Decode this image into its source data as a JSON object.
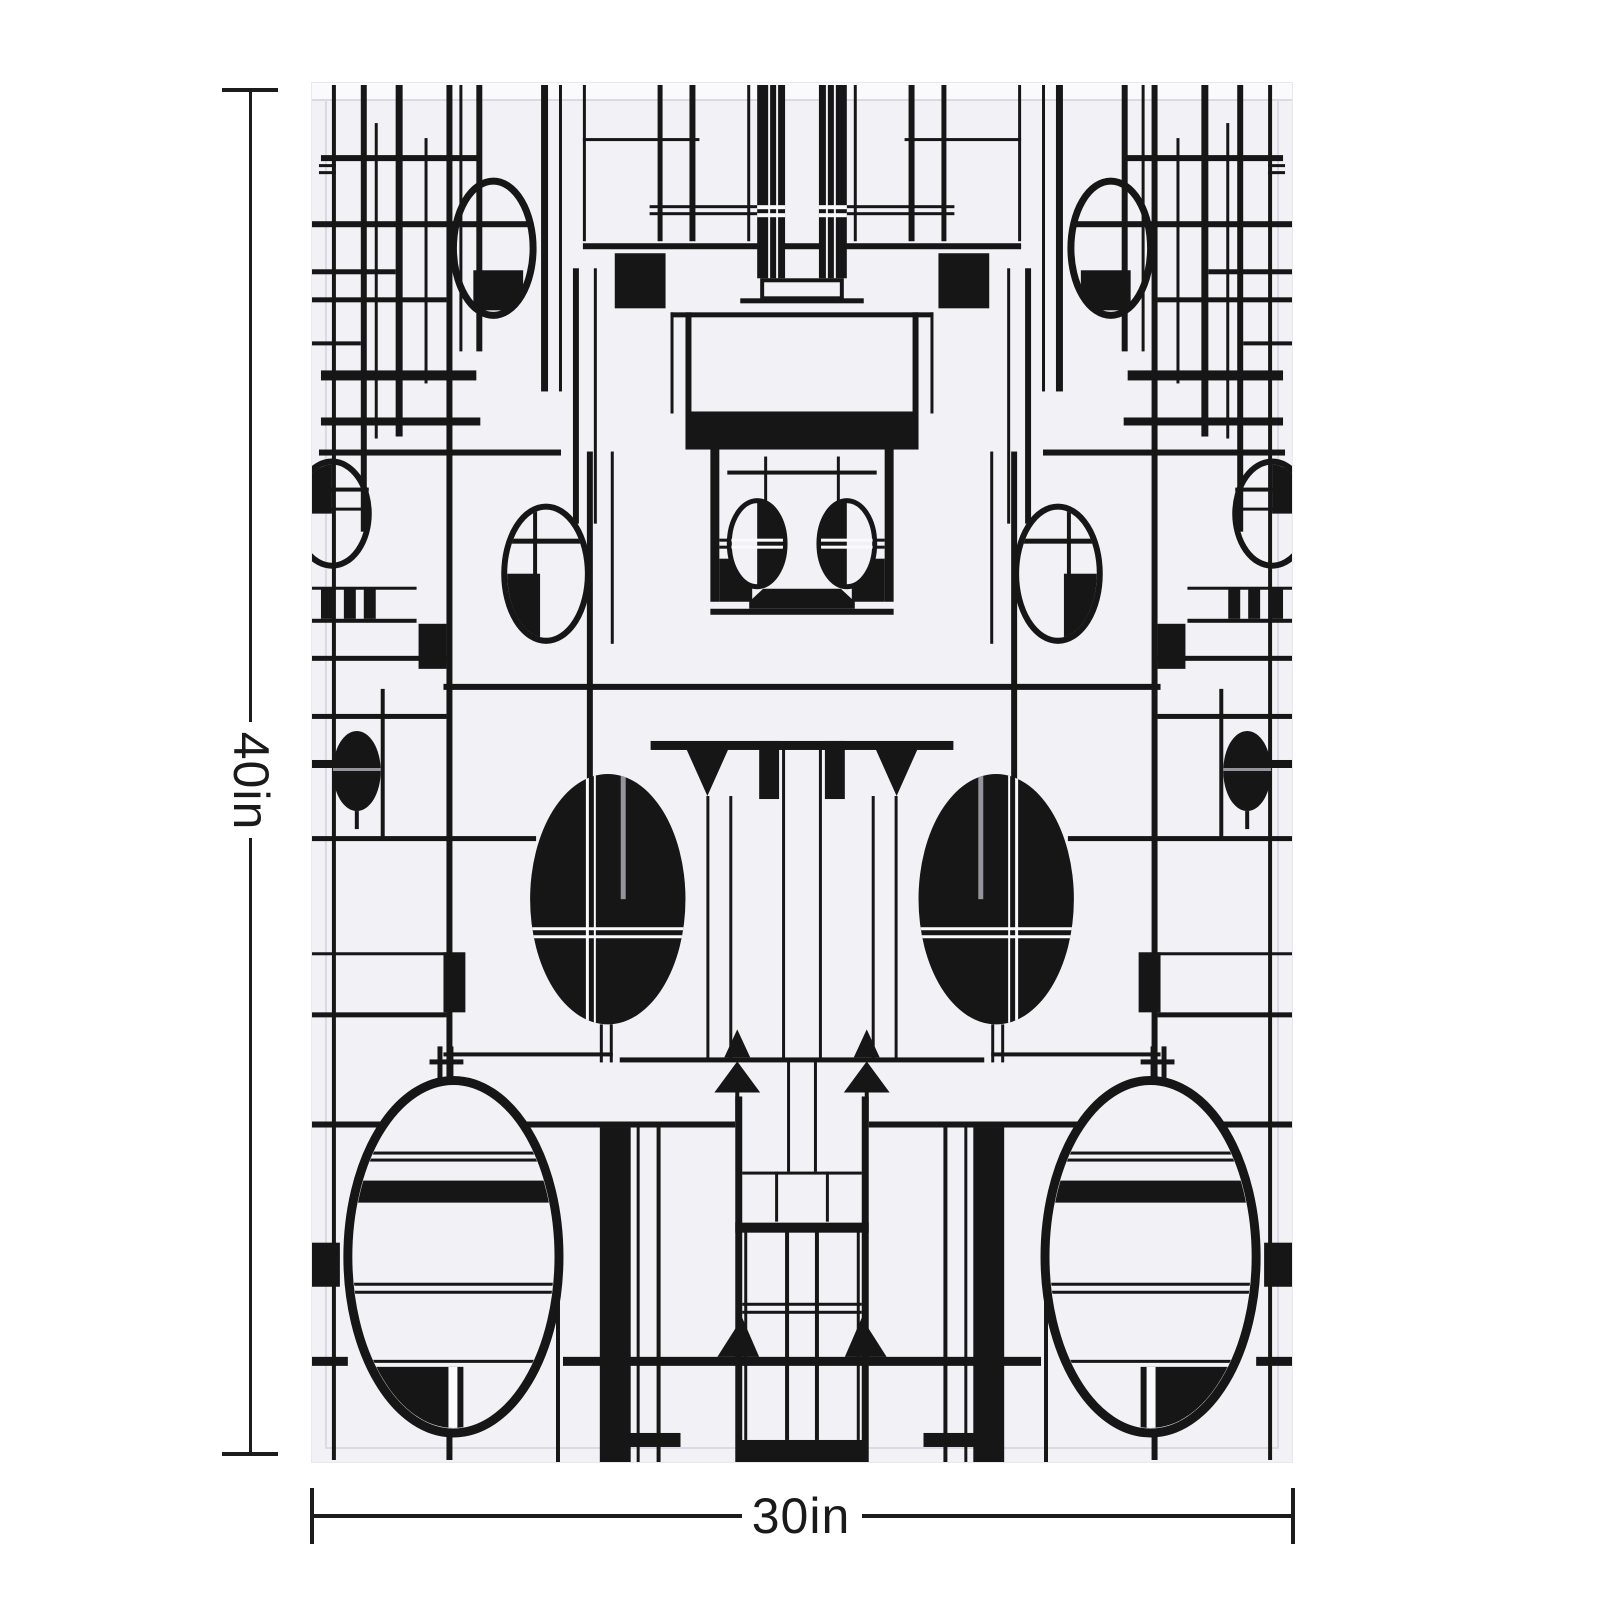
{
  "image_type": "product size mockup",
  "artwork": {
    "title": "black-white-geometric-abstract-pattern",
    "style": "Mondrian and Art-Deco inspired mirror-symmetric composition of black grid lines, rectangles, triangles and ellipses on a pale panel",
    "colors": {
      "ink": "#161616",
      "panel": "#f2f2f6",
      "panel_bright": "#fafafc",
      "frame_line": "#d9dae3",
      "detail_gray": "#94949c",
      "page": "#ffffff",
      "dimension_line": "#1c1c1c"
    }
  },
  "dimensions": {
    "height_label": "40in",
    "width_label": "30in"
  }
}
